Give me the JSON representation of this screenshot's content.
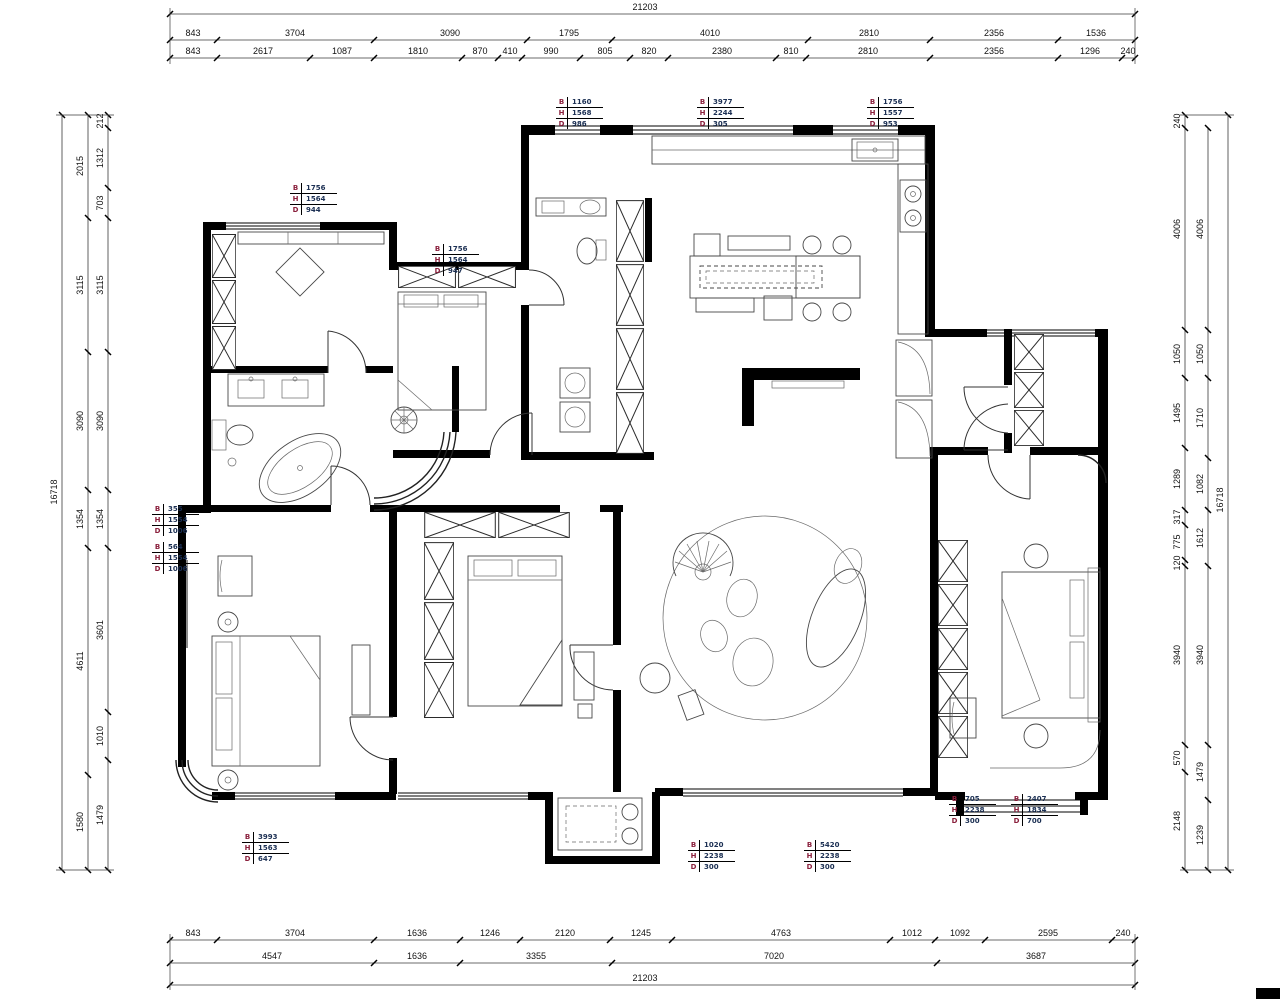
{
  "labels": {
    "b": "B",
    "h": "H",
    "d": "D"
  },
  "colors": {
    "letter": "#8a1f3c",
    "value": "#1a2e52",
    "line": "#000000",
    "wall": "#000000"
  },
  "dims": {
    "top": {
      "total": "21203",
      "row2": [
        "843",
        "3704",
        "3090",
        "1795",
        "4010",
        "2810",
        "2356",
        "1536"
      ],
      "row3": [
        "843",
        "2617",
        "1087",
        "1810",
        "870",
        "410",
        "990",
        "805",
        "820",
        "2380",
        "810",
        "2810",
        "2356",
        "1296",
        "240"
      ]
    },
    "bottom": {
      "row1": [
        "843",
        "3704",
        "1636",
        "1246",
        "2120",
        "1245",
        "4763",
        "1012",
        "1092",
        "2595",
        "240"
      ],
      "row2": [
        "4547",
        "1636",
        "3355",
        "7020",
        "3687"
      ],
      "total": "21203"
    },
    "left": {
      "total": "16718",
      "mid": [
        "2015",
        "3115",
        "3090",
        "1354",
        "4611",
        "1580"
      ],
      "inner": [
        "212",
        "1312",
        "703",
        "3115",
        "3090",
        "1354",
        "3601",
        "1010",
        "1479"
      ]
    },
    "right": {
      "total": "16718",
      "inner": [
        "240",
        "4006",
        "1050",
        "1495",
        "1289",
        "317",
        "775",
        "120",
        "3940",
        "570",
        "2148"
      ],
      "mid": [
        "4006",
        "1050",
        "1710",
        "1082",
        "1612",
        "3940",
        "1479",
        "1239"
      ]
    }
  },
  "annotations": [
    {
      "b": "1160",
      "h": "1568",
      "d": "986"
    },
    {
      "b": "3977",
      "h": "2244",
      "d": "305"
    },
    {
      "b": "1756",
      "h": "1557",
      "d": "953"
    },
    {
      "b": "1756",
      "h": "1564",
      "d": "944"
    },
    {
      "b": "1756",
      "h": "1564",
      "d": "947"
    },
    {
      "b": "355",
      "h": "1554",
      "d": "1006"
    },
    {
      "b": "564",
      "h": "1554",
      "d": "1006"
    },
    {
      "b": "3993",
      "h": "1563",
      "d": "647"
    },
    {
      "b": "1020",
      "h": "2238",
      "d": "300"
    },
    {
      "b": "5420",
      "h": "2238",
      "d": "300"
    },
    {
      "b": "705",
      "h": "2238",
      "d": "300"
    },
    {
      "b": "2407",
      "h": "1834",
      "d": "700"
    }
  ]
}
